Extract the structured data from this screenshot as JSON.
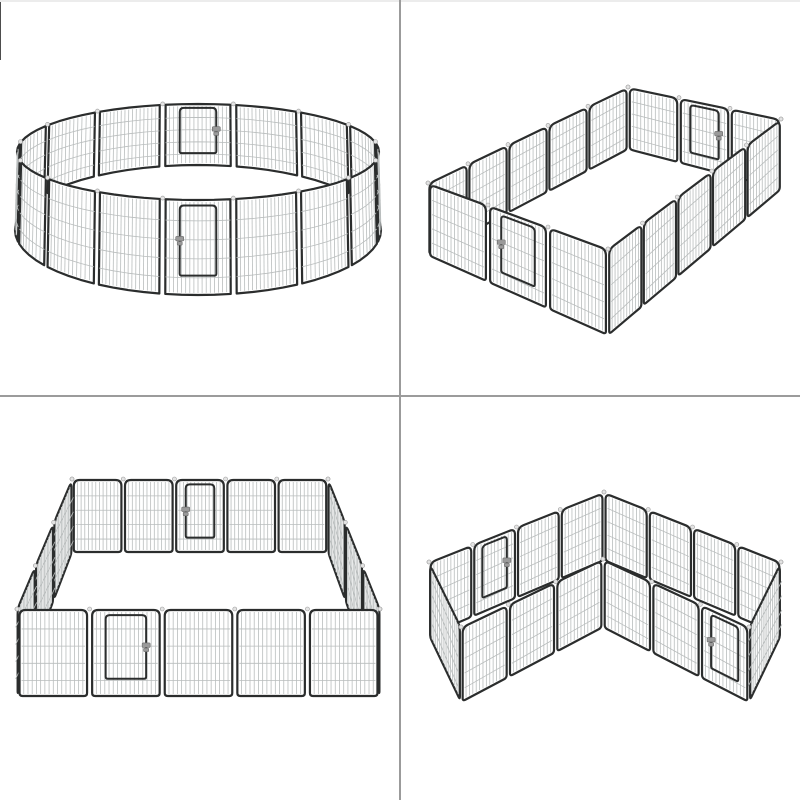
{
  "page": {
    "background": "#ffffff",
    "divider_color": "#9b9b9b",
    "top_edge_color": "#ececec",
    "left_artifact_color": "#4d4d4d"
  },
  "product": {
    "name": "Heavy-duty 16-panel metal pet playpen with doors",
    "panel_count": 16,
    "colors": {
      "frame": "#2b2d2d",
      "mesh": "#b9bdbd",
      "knob": "#e3e3e3",
      "latch": "#9a9a9a",
      "panel_fill": "#ffffff"
    }
  },
  "views": [
    {
      "layout": "circle",
      "position": "top-left",
      "label": "16-panel metal playpen arranged in a circle with front and back door panels"
    },
    {
      "layout": "rectangle",
      "position": "top-right",
      "label": "16-panel metal playpen arranged in a rectangle with door panels on two short walls"
    },
    {
      "layout": "square",
      "position": "bottom-left",
      "label": "16-panel metal playpen arranged in a square with door panels on front and back walls"
    },
    {
      "layout": "l-shape",
      "position": "bottom-right",
      "label": "16-panel metal playpen arranged in an L-shape with door panels on back and front walls"
    }
  ]
}
